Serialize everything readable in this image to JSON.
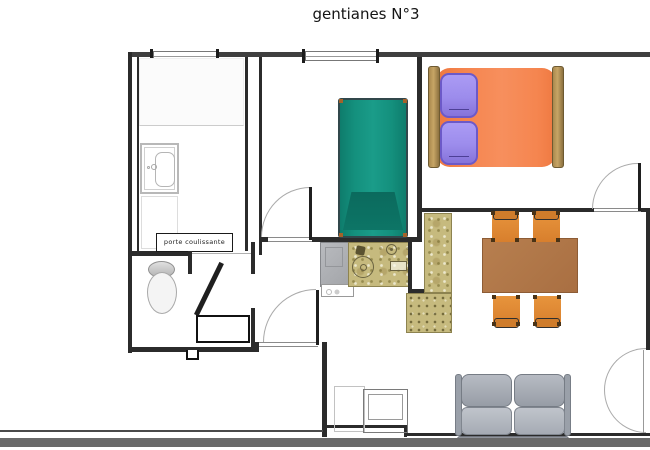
{
  "title": "gentianes N°3",
  "labels": {
    "sliding_door": "porte coulissante"
  },
  "colors": {
    "wall": "#2b2b2b",
    "outer_wall": "#3f3f3f",
    "single_bed": "#14907d",
    "single_bed_dark": "#0b6a5d",
    "double_bed": "#f5854f",
    "pillow": "#9c8cec",
    "bed_frame": "#c7a566",
    "table": "#b0784a",
    "chair": "#e18a36",
    "tile": "#c6ba7e",
    "appliance": "#aeb0b4",
    "sofa": "#abafb8",
    "terrace_band": "#696969"
  }
}
